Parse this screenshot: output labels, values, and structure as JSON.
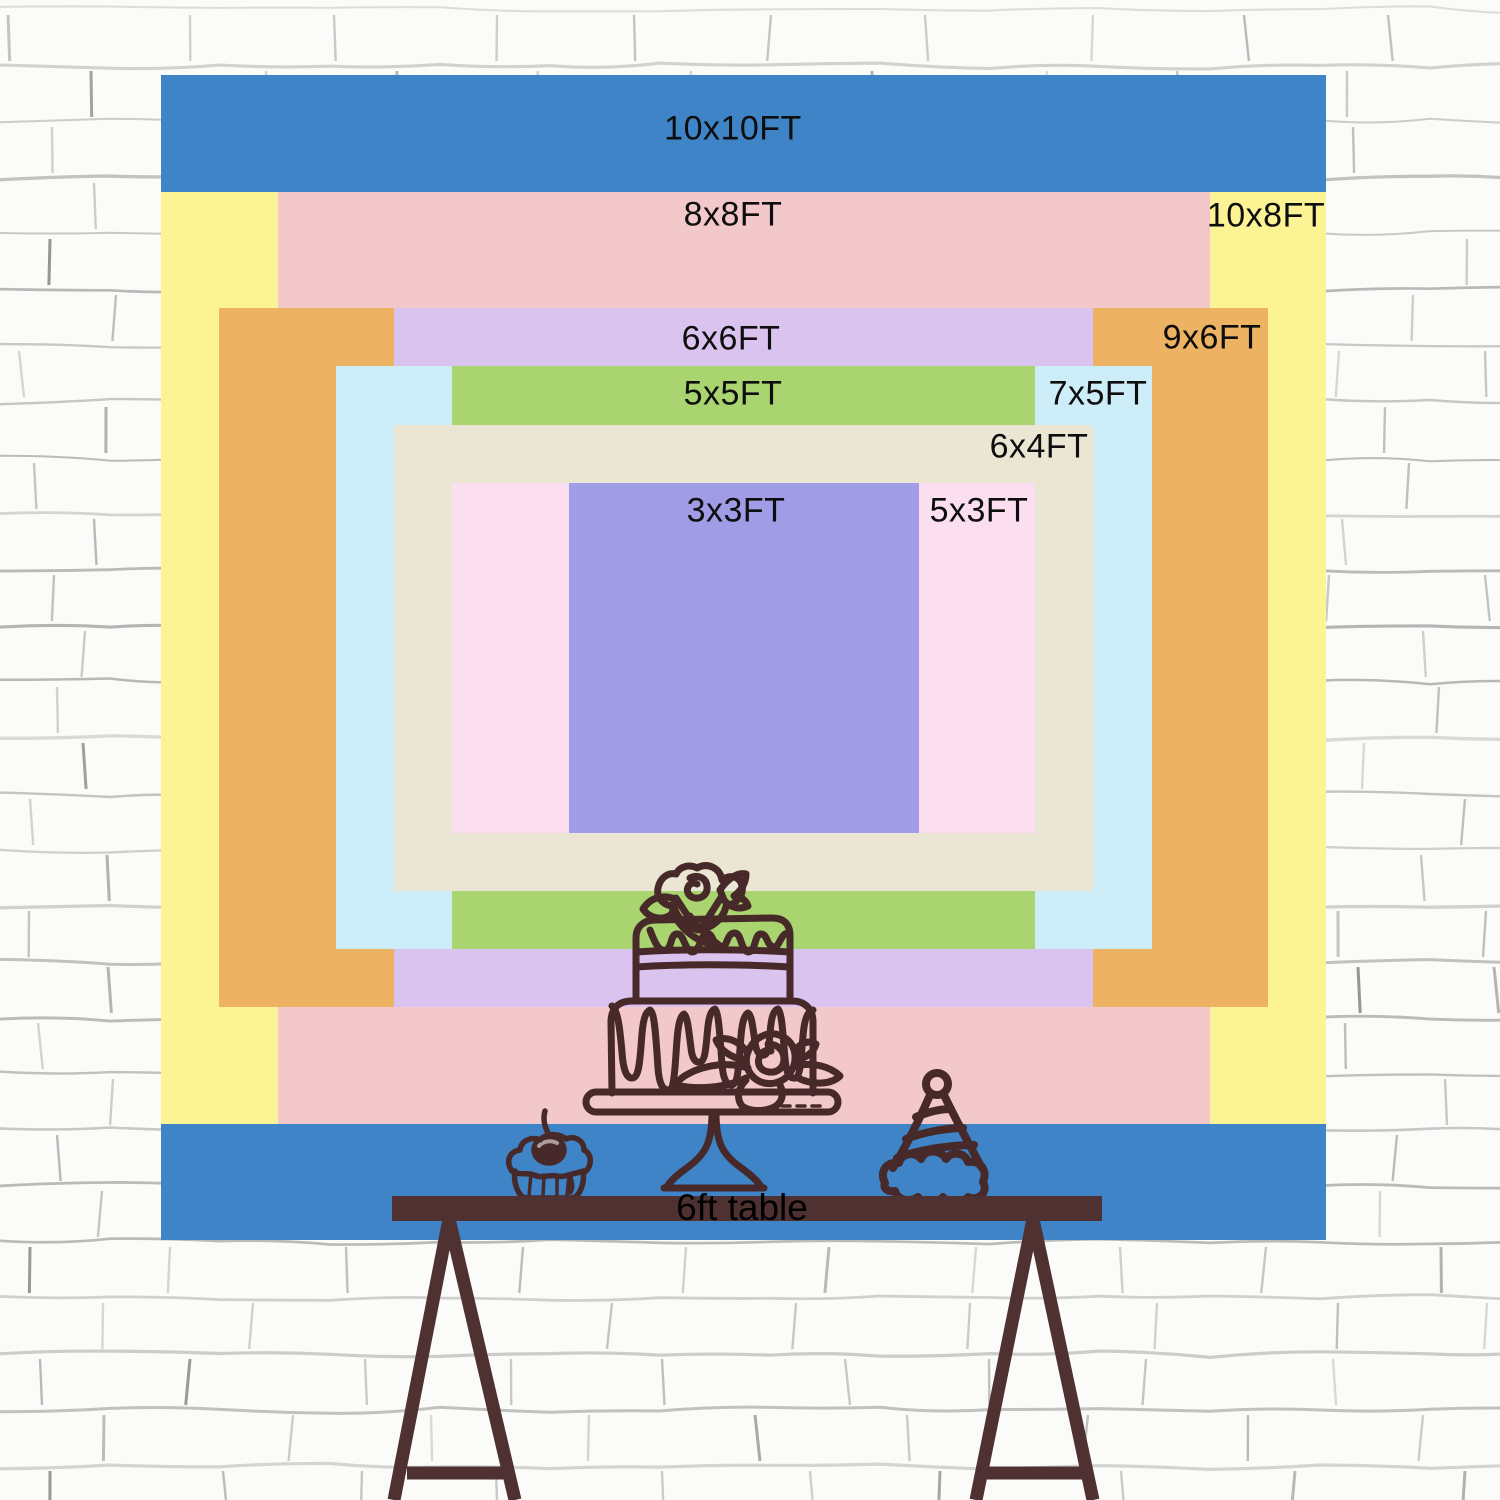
{
  "scene": {
    "description": "Backdrop size comparison chart hung on a white brick wall above a trestle table",
    "background": "white brick wall",
    "table_label": "6ft table"
  },
  "sizes": [
    {
      "label": "10x10FT",
      "color": "#3e84c6"
    },
    {
      "label": "10x8FT",
      "color": "#fcf394"
    },
    {
      "label": "8x8FT",
      "color": "#f3c8cb"
    },
    {
      "label": "9x6FT",
      "color": "#edb363"
    },
    {
      "label": "6x6FT",
      "color": "#dac4ef"
    },
    {
      "label": "7x5FT",
      "color": "#cdedf8"
    },
    {
      "label": "5x5FT",
      "color": "#a9d46f"
    },
    {
      "label": "6x4FT",
      "color": "#ebe6d4"
    },
    {
      "label": "5x3FT",
      "color": "#fbdff0"
    },
    {
      "label": "3x3FT",
      "color": "#a09ce6"
    }
  ],
  "illustrations": {
    "cake": "two-tier-cake-on-stand-line-art",
    "cupcake": "cupcake-with-cherry-line-art",
    "hat": "party-hat-line-art",
    "line_color": "#47292a",
    "table_color": "#4f3132"
  },
  "chart_data": {
    "type": "table",
    "title": "Backdrop size comparison (feet)",
    "categories": [
      "10x10FT",
      "8x8FT",
      "10x8FT",
      "6x6FT",
      "9x6FT",
      "5x5FT",
      "7x5FT",
      "6x4FT",
      "3x3FT",
      "5x3FT"
    ],
    "series": [
      {
        "name": "width_ft",
        "values": [
          10,
          8,
          10,
          6,
          9,
          5,
          7,
          6,
          3,
          5
        ]
      },
      {
        "name": "height_ft",
        "values": [
          10,
          8,
          8,
          6,
          6,
          5,
          5,
          4,
          3,
          3
        ]
      }
    ],
    "annotations": [
      "6ft table"
    ],
    "legend": false,
    "grid": false
  }
}
